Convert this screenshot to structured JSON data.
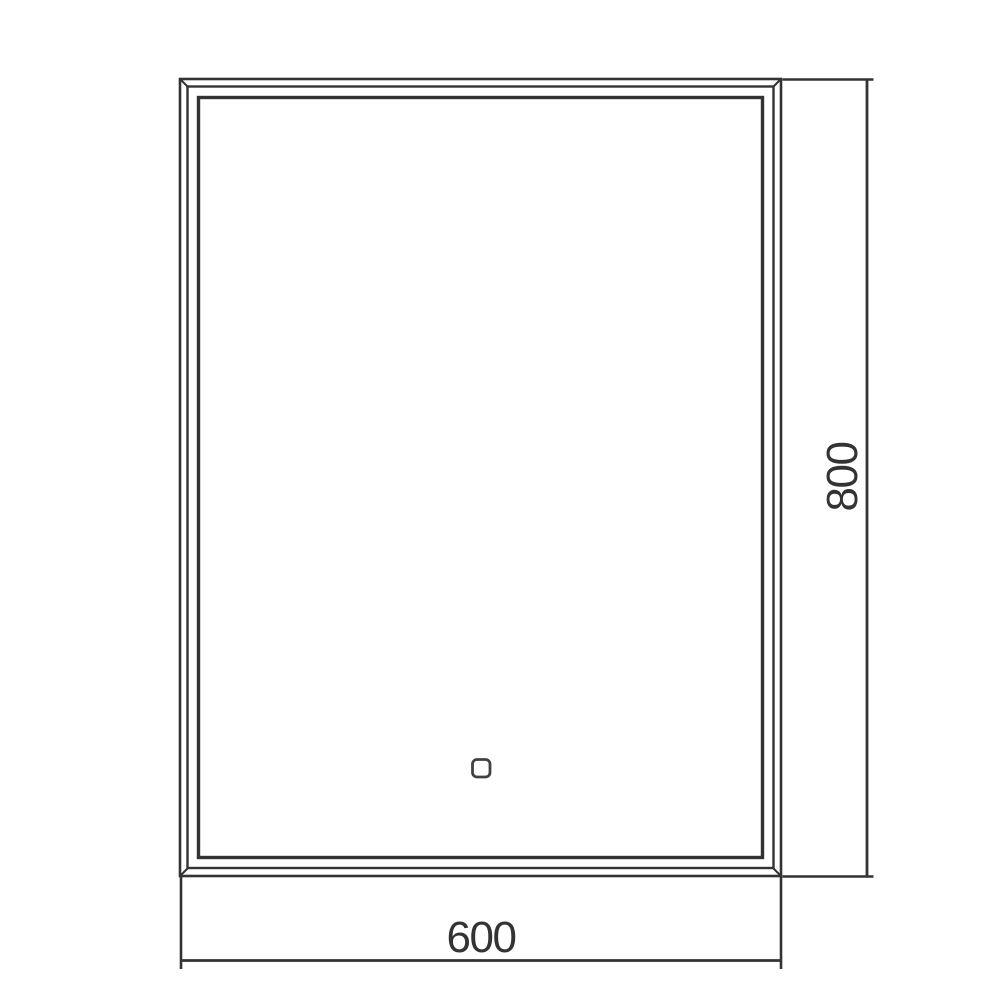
{
  "drawing": {
    "line_color": "#333333",
    "text_color": "#333333",
    "background": "#ffffff",
    "dimensions": {
      "width_label": "600",
      "height_label": "800"
    },
    "icons": {
      "touch_sensor": "rounded-square-button"
    }
  }
}
